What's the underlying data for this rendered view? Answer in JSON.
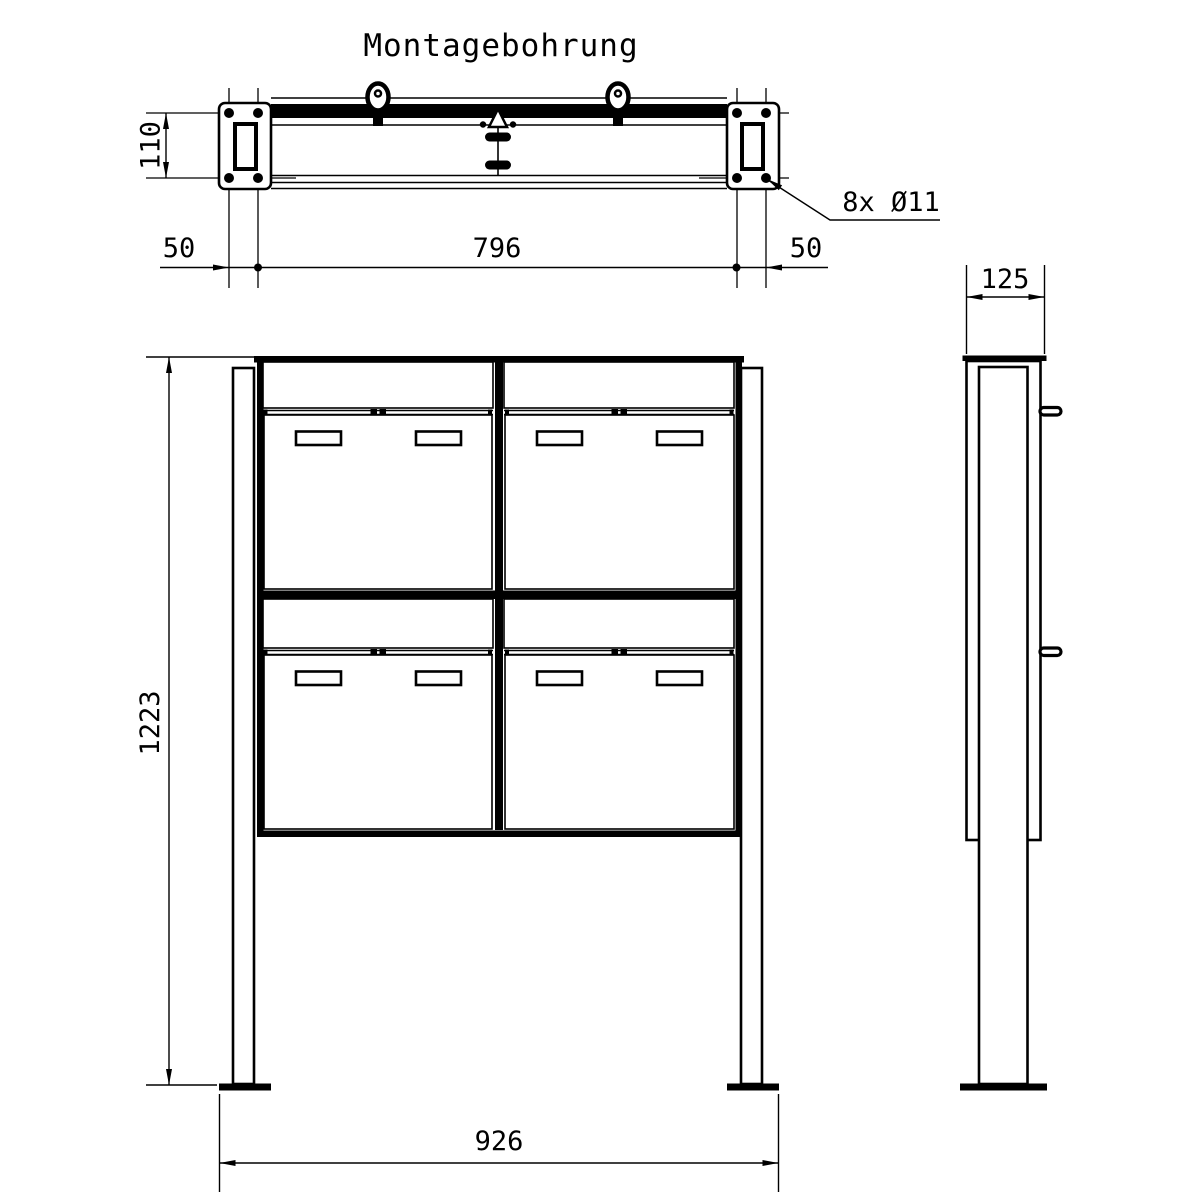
{
  "drawing": {
    "title": "Montagebohrung",
    "line_color": "#000000",
    "background": "#ffffff",
    "top_view": {
      "dim_plate_height": "110",
      "dim_left_offset": "50",
      "dim_hole_span": "796",
      "dim_right_offset": "50",
      "hole_callout": "8x Ø11"
    },
    "front_view": {
      "dim_total_height": "1223",
      "dim_foot_span": "926"
    },
    "side_view": {
      "dim_depth": "125"
    }
  }
}
